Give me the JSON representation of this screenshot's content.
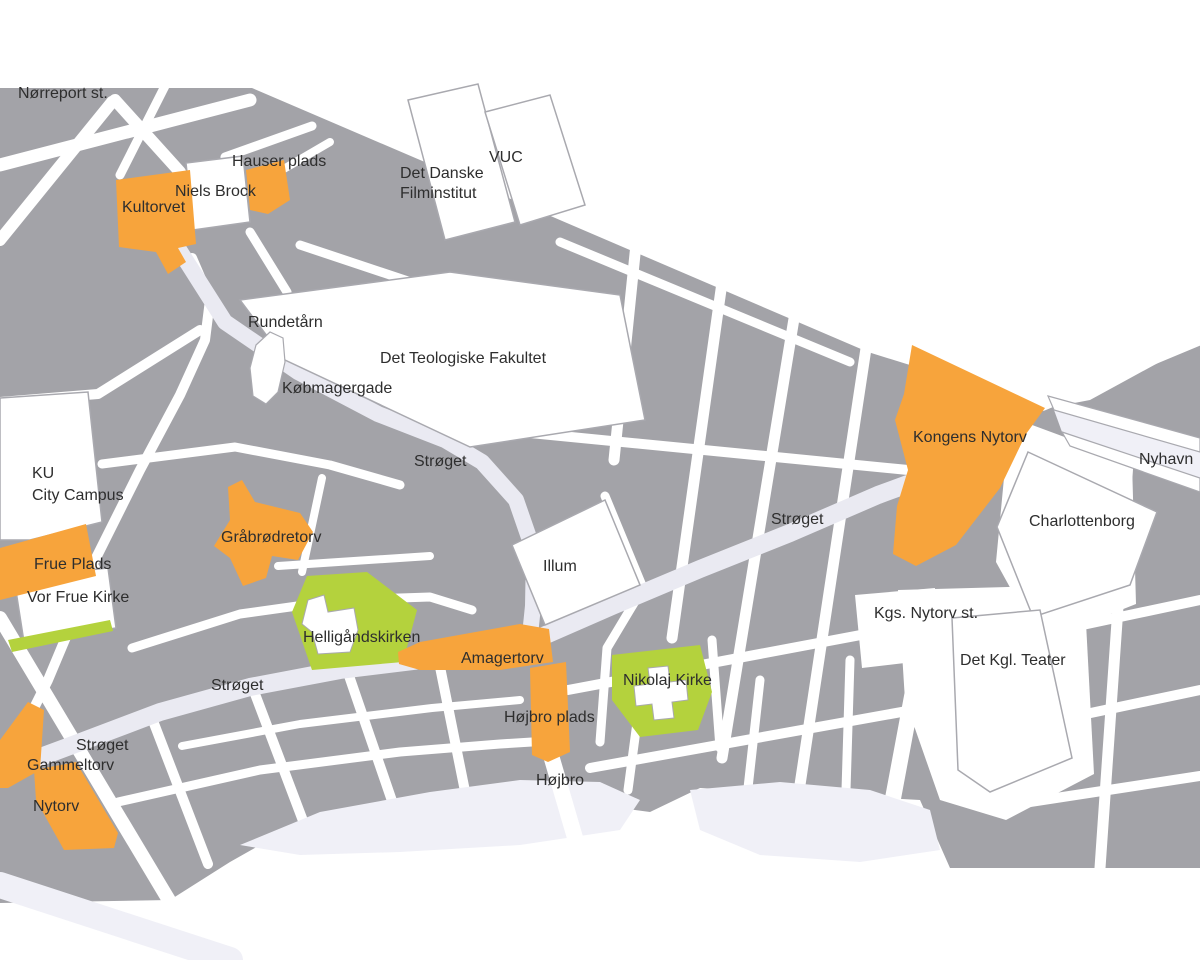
{
  "map": {
    "kind": "city-centre street map, Copenhagen",
    "colors": {
      "background": "#FFFFFF",
      "block": "#A3A3A8",
      "street": "#FFFFFF",
      "pedestrian": "#EAEAF2",
      "water": "#F0F0F7",
      "outline": "#A9A9AF",
      "highlight": "#F7A43C",
      "green": "#B4D23D",
      "label": "#2E2E2E"
    },
    "highlighted_squares_orange": [
      "Kultorvet",
      "Hauser plads",
      "Frue Plads",
      "Gråbrødretorv",
      "Amagertorv",
      "Højbro plads",
      "Gammeltorv",
      "Nytorv",
      "Kongens Nytorv"
    ],
    "green_areas": [
      "Helligåndskirken",
      "Nikolaj Kirke",
      "Vor Frue Kirke"
    ],
    "white_landmarks": [
      "Niels Brock",
      "Det Danske Filminstitut",
      "VUC",
      "Rundetårn",
      "Det Teologiske Fakultet",
      "KU City Campus",
      "Vor Frue Kirke",
      "Illum",
      "Charlottenborg",
      "Det Kgl. Teater"
    ],
    "streets_named": [
      "Strøget",
      "Købmagergade",
      "Nyhavn",
      "Højbro"
    ],
    "stations": [
      "Nørreport st.",
      "Kgs. Nytorv st."
    ],
    "labels": [
      {
        "id": "noerreport-st",
        "text": "Nørreport st.",
        "x": 18,
        "y": 98
      },
      {
        "id": "hauser-plads",
        "text": "Hauser plads",
        "x": 232,
        "y": 166
      },
      {
        "id": "niels-brock",
        "text": "Niels Brock",
        "x": 175,
        "y": 196
      },
      {
        "id": "kultorvet",
        "text": "Kultorvet",
        "x": 122,
        "y": 212
      },
      {
        "id": "det-danske-filminstitut-1",
        "text": "Det Danske",
        "x": 400,
        "y": 178
      },
      {
        "id": "det-danske-filminstitut-2",
        "text": "Filminstitut",
        "x": 400,
        "y": 198
      },
      {
        "id": "vuc",
        "text": "VUC",
        "x": 489,
        "y": 162
      },
      {
        "id": "rundetaarn",
        "text": "Rundetårn",
        "x": 248,
        "y": 327
      },
      {
        "id": "det-teologiske-fakultet",
        "text": "Det Teologiske Fakultet",
        "x": 380,
        "y": 363
      },
      {
        "id": "koebmagergade",
        "text": "Købmagergade",
        "x": 282,
        "y": 393
      },
      {
        "id": "stroeget-north",
        "text": "Strøget",
        "x": 414,
        "y": 466
      },
      {
        "id": "ku-city-campus-1",
        "text": "KU",
        "x": 32,
        "y": 478
      },
      {
        "id": "ku-city-campus-2",
        "text": "City Campus",
        "x": 32,
        "y": 500
      },
      {
        "id": "graabroedretorv",
        "text": "Gråbrødretorv",
        "x": 221,
        "y": 542
      },
      {
        "id": "frue-plads",
        "text": "Frue Plads",
        "x": 34,
        "y": 569
      },
      {
        "id": "vor-frue-kirke",
        "text": "Vor Frue Kirke",
        "x": 27,
        "y": 602
      },
      {
        "id": "illum",
        "text": "Illum",
        "x": 543,
        "y": 571
      },
      {
        "id": "stroeget-east",
        "text": "Strøget",
        "x": 771,
        "y": 524
      },
      {
        "id": "kongens-nytorv",
        "text": "Kongens Nytorv",
        "x": 913,
        "y": 442
      },
      {
        "id": "nyhavn",
        "text": "Nyhavn",
        "x": 1139,
        "y": 464
      },
      {
        "id": "charlottenborg",
        "text": "Charlottenborg",
        "x": 1029,
        "y": 526
      },
      {
        "id": "kgs-nytorv-st",
        "text": "Kgs. Nytorv st.",
        "x": 874,
        "y": 618
      },
      {
        "id": "det-kgl-teater",
        "text": "Det Kgl. Teater",
        "x": 960,
        "y": 665
      },
      {
        "id": "helligaandskirken",
        "text": "Helligåndskirken",
        "x": 303,
        "y": 642
      },
      {
        "id": "amagertorv",
        "text": "Amagertorv",
        "x": 461,
        "y": 663
      },
      {
        "id": "nikolaj-kirke",
        "text": "Nikolaj Kirke",
        "x": 623,
        "y": 685
      },
      {
        "id": "hoejbro-plads",
        "text": "Højbro plads",
        "x": 504,
        "y": 722
      },
      {
        "id": "hoejbro",
        "text": "Højbro",
        "x": 536,
        "y": 785
      },
      {
        "id": "stroeget-mid",
        "text": "Strøget",
        "x": 211,
        "y": 690
      },
      {
        "id": "stroeget-southwest",
        "text": "Strøget",
        "x": 76,
        "y": 750
      },
      {
        "id": "gammeltorv",
        "text": "Gammeltorv",
        "x": 27,
        "y": 770
      },
      {
        "id": "nytorv",
        "text": "Nytorv",
        "x": 33,
        "y": 811
      }
    ]
  }
}
